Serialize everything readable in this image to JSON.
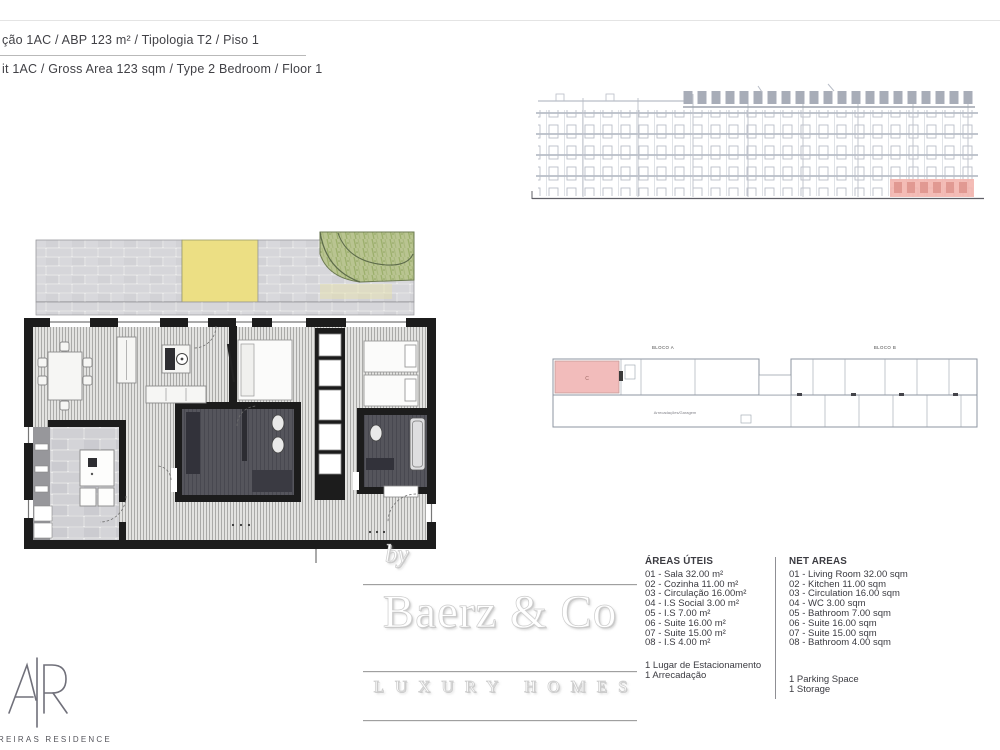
{
  "header": {
    "line1_pt": "ção 1AC / ABP 123 m²  / Tipologia T2 / Piso 1",
    "line2_en": "it 1AC / Gross Area 123 sqm / Type 2 Bedroom / Floor 1"
  },
  "branding": {
    "by_label": "by",
    "name": "Baerz & Co",
    "tagline": "LUXURY HOMES"
  },
  "developer": {
    "residence_label": "REIRAS RESIDENCE"
  },
  "areas_pt": {
    "title": "ÁREAS ÚTEIS",
    "items": [
      "01 - Sala 32.00 m²",
      "02 - Cozinha 11.00 m²",
      "03 - Circulação 16.00m²",
      "04 - I.S Social 3.00 m²",
      "05 - I.S 7.00 m²",
      "06 - Suite 16.00 m²",
      "07 - Suite 15.00 m²",
      "08 - I.S 4.00 m²"
    ],
    "extras": [
      "1 Lugar de Estacionamento",
      "1 Arrecadação"
    ]
  },
  "areas_en": {
    "title": "NET AREAS",
    "items": [
      "01 - Living Room 32.00 sqm",
      "02 - Kitchen 11.00 sqm",
      "03 - Circulation 16.00 sqm",
      "04 - WC 3.00 sqm",
      "05 - Bathroom 7.00 sqm",
      "06 - Suite 16.00 sqm",
      "07 - Suite 15.00 sqm",
      "08 - Bathroom 4.00 sqm"
    ],
    "extras": [
      "1 Parking Space",
      "1 Storage"
    ]
  },
  "key_plan": {
    "block_a_label": "BLOCO A",
    "block_b_label": "BLOCO B",
    "center_label": "Arrecadações/Garagem",
    "unit_letter": "C"
  },
  "colors": {
    "highlight_pink": "#f2b7b2",
    "terrace_yellow": "#ecdf84",
    "garden_green": "#b9c491",
    "wall_black": "#1c1c1c",
    "bath_dark": "#55555c"
  }
}
